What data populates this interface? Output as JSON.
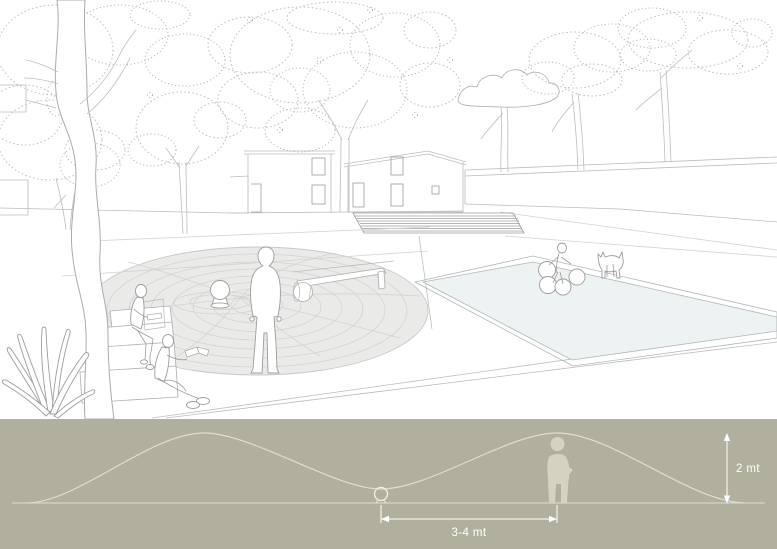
{
  "section_diagram": {
    "distance_label": "3-4 mt",
    "height_label": "2 mt"
  },
  "colors": {
    "canvas_bg": "#ffffff",
    "band_bg": "#b1b09e",
    "band_line": "#deddce",
    "silhouette": "#d5d2c4",
    "dimension": "#ffffff",
    "sketch_line": "#bdbdbd",
    "sketch_dark": "#9c9c9c",
    "mound_fill": "#eaeae8",
    "mound_ring": "#d3d3d1",
    "pool_fill": "#edf2f2",
    "pool_line": "#b2b7b7"
  }
}
